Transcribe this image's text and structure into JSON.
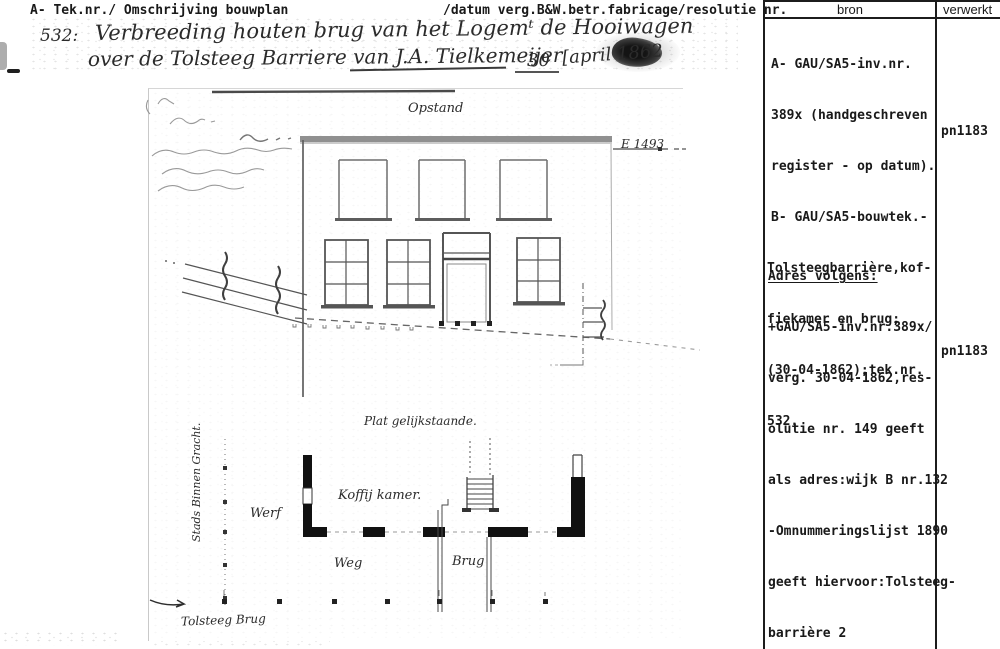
{
  "colors": {
    "ink": "#191919",
    "pencil": "#949494"
  },
  "header": {
    "left": "A- Tek.nr./ Omschrijving bouwplan",
    "right": "/datum verg.B&W.betr.fabricage/resolutie nr.",
    "col_bron": "bron",
    "col_verwerkt": "verwerkt"
  },
  "table": {
    "entry1": {
      "line0": "A- GAU/SA5-inv.nr.",
      "line1": "389x (handgeschreven",
      "line2": "register - op datum).",
      "line3": "B- GAU/SA5-bouwtek.-",
      "line4": "Tolsteegbarrière,kof-",
      "line5": "fiekamer en brug;",
      "line6": "(30-04-1862);tek.nr.",
      "line7": "532.",
      "verwerkt": "pn1183"
    },
    "entry2": {
      "heading": "Adres volgens:",
      "line0": "+GAU/SA5-inv.nr.389x/",
      "line1": "verg. 30-04-1862,res-",
      "line2": "olutie nr. 149 geeft",
      "line3": "als adres:wijk B nr.132",
      "line4": "-Omnummeringslijst 1890",
      "line5": "geeft hiervoor:Tolsteeg-",
      "line6": "barrière 2",
      "verwerkt": "pn1183"
    }
  },
  "manuscript": {
    "number": "532:",
    "title_line1": "Verbreeding houten brug van het Logemᵗ de Hooiwagen",
    "title_line2": "over de Tolsteeg Barriere van J.A. Tielkemeijer",
    "day": "30",
    "date": "[april 1862"
  },
  "drawing": {
    "label_opstand": "Opstand",
    "label_e_number": "E 1493",
    "label_plat": "Plat gelijkstaande.",
    "label_gracht": "Stads Binnen Gracht.",
    "label_werf": "Werf",
    "label_koffij": "Koffij kamer.",
    "label_weg": "Weg",
    "label_brug": "Brug",
    "label_tolsteeg_brug": "Tolsteeg Brug"
  }
}
